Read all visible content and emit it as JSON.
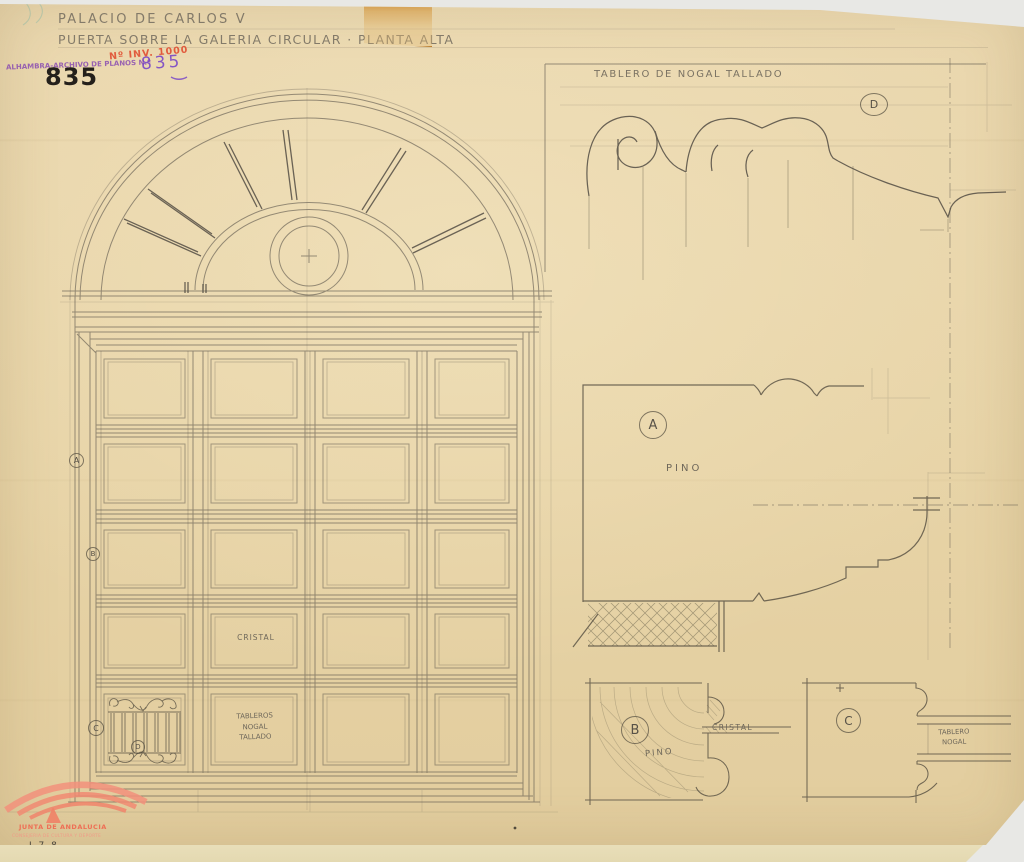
{
  "document": {
    "title_line1": "PALACIO DE CARLOS V",
    "title_line2": "PUERTA SOBRE LA GALERIA CIRCULAR · PLANTA ALTA",
    "inventory_stamp": "Nº INV. 1000",
    "archive_stamp_label": "ALHAMBRA-ARCHIVO DE PLANOS N.º",
    "archive_number_handwritten": "835",
    "archive_number_printed": "835"
  },
  "door_elevation": {
    "glass_label": "CRISTAL",
    "panel_label_lines": [
      "TABLEROS",
      "NOGAL",
      "TALLADO"
    ],
    "marker_a": "A",
    "marker_b": "B",
    "marker_c": "C",
    "marker_d": "D"
  },
  "details": {
    "caption": "TABLERO DE NOGAL TALLADO",
    "marker_a": "A",
    "marker_b": "B",
    "marker_c": "C",
    "marker_d": "D",
    "material_a": "PINO",
    "material_b": "PINO",
    "glass_b": "CRISTAL",
    "panel_c_lines": [
      "TABLERO",
      "NOGAL"
    ]
  },
  "footer": {
    "org": "JUNTA DE ANDALUCIA",
    "dept": "CONSEJERIA DE CULTURA Y DEPORTE",
    "ref": "J.7.8."
  },
  "colors": {
    "paper": "#e7d3a6",
    "pencil": "#57524a",
    "stamp_red": "#e0462a",
    "stamp_purple": "#7b3fae",
    "ink_black": "#24201b",
    "logo_salmon": "#ee7a60",
    "tape": "#cf8c2d",
    "background": "#e8e8e5"
  }
}
